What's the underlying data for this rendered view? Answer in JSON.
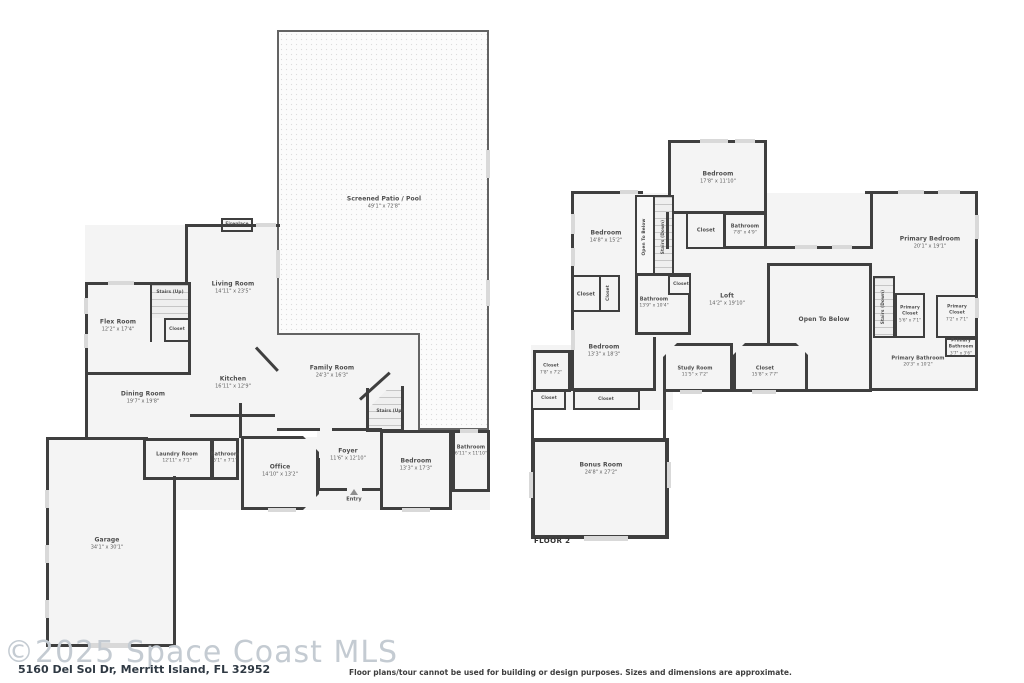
{
  "footer": {
    "watermark": "©2025 Space Coast MLS",
    "address": "5160 Del Sol Dr, Merritt Island, FL 32952",
    "disclaimer": "Floor plans/tour cannot be used for building or design purposes. Sizes and dimensions are approximate."
  },
  "colors": {
    "wall": "#3f3f3f",
    "room_fill": "#f4f4f4",
    "window": "#d9d9d9",
    "watermark_text": "#c4cbd2",
    "label_text": "#4d4d4d"
  },
  "floor1": {
    "rooms": [
      {
        "name": "Screened Patio / Pool",
        "dims": "49'1\" x 72'8\""
      },
      {
        "name": "Fireplace",
        "dims": ""
      },
      {
        "name": "Living Room",
        "dims": "14'11\" x 23'5\""
      },
      {
        "name": "Stairs (Up)",
        "dims": ""
      },
      {
        "name": "Closet",
        "dims": ""
      },
      {
        "name": "Flex Room",
        "dims": "12'2\" x 17'4\""
      },
      {
        "name": "Dining Room",
        "dims": "19'7\" x 19'8\""
      },
      {
        "name": "Kitchen",
        "dims": "16'11\" x 12'9\""
      },
      {
        "name": "Family Room",
        "dims": "24'3\" x 16'3\""
      },
      {
        "name": "Stairs (Up)",
        "dims": ""
      },
      {
        "name": "Foyer",
        "dims": "11'6\" x 12'10\""
      },
      {
        "name": "Laundry Room",
        "dims": "12'11\" x 7'1\""
      },
      {
        "name": "Bathroom",
        "dims": "5'1\" x 7'1\""
      },
      {
        "name": "Office",
        "dims": "14'10\" x 13'2\""
      },
      {
        "name": "Bedroom",
        "dims": "13'3\" x 17'3\""
      },
      {
        "name": "Bathroom",
        "dims": "6'11\" x 11'10\""
      },
      {
        "name": "Entry",
        "dims": ""
      },
      {
        "name": "Garage",
        "dims": "34'1\" x 30'1\""
      }
    ]
  },
  "floor2": {
    "title": "FLOOR 2",
    "rooms": [
      {
        "name": "Bedroom",
        "dims": "17'8\" x 11'10\""
      },
      {
        "name": "Bedroom",
        "dims": "14'8\" x 15'2\""
      },
      {
        "name": "Open To Below",
        "dims": ""
      },
      {
        "name": "Stairs (Down)",
        "dims": ""
      },
      {
        "name": "Closet",
        "dims": ""
      },
      {
        "name": "Bathroom",
        "dims": "7'8\" x 4'9\""
      },
      {
        "name": "Closet",
        "dims": ""
      },
      {
        "name": "Closet",
        "dims": ""
      },
      {
        "name": "Bathroom",
        "dims": "13'9\" x 10'4\""
      },
      {
        "name": "Closet",
        "dims": ""
      },
      {
        "name": "Loft",
        "dims": "14'2\" x 19'10\""
      },
      {
        "name": "Open To Below",
        "dims": ""
      },
      {
        "name": "Primary Bedroom",
        "dims": "20'1\" x 19'1\""
      },
      {
        "name": "Stairs (Down)",
        "dims": ""
      },
      {
        "name": "Primary Closet",
        "dims": "5'6\" x 7'1\""
      },
      {
        "name": "Primary Closet",
        "dims": "7'2\" x 7'1\""
      },
      {
        "name": "Primary Bathroom",
        "dims": "3'7\" x 3'6\""
      },
      {
        "name": "Primary Bathroom",
        "dims": "20'3\" x 10'2\""
      },
      {
        "name": "Bedroom",
        "dims": "13'3\" x 18'3\""
      },
      {
        "name": "Study Room",
        "dims": "11'5\" x 7'2\""
      },
      {
        "name": "Closet",
        "dims": "15'8\" x 7'7\""
      },
      {
        "name": "Closet",
        "dims": "7'8\" x 7'2\""
      },
      {
        "name": "Closet",
        "dims": ""
      },
      {
        "name": "Closet",
        "dims": ""
      },
      {
        "name": "Bonus Room",
        "dims": "24'8\" x 27'2\""
      }
    ]
  }
}
